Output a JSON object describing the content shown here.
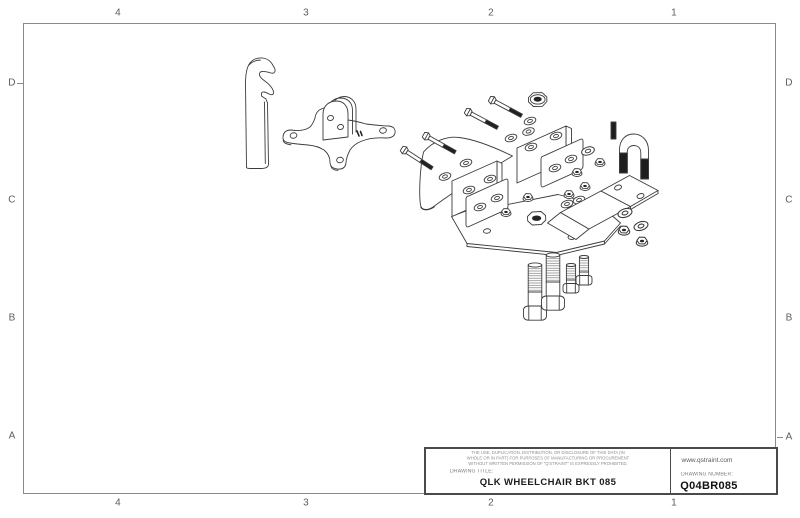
{
  "sheet": {
    "background": "#ffffff",
    "border_color": "#8a8a8a",
    "line_color": "#3c3c3c"
  },
  "zones": {
    "top": [
      "4",
      "3",
      "2",
      "1"
    ],
    "bottom": [
      "4",
      "3",
      "2",
      "1"
    ],
    "left": [
      "D",
      "C",
      "B",
      "A"
    ],
    "right": [
      "D",
      "C",
      "B",
      "A"
    ]
  },
  "title_block": {
    "disclaimer_line1": "THE USE, DUPLICATION, DISTRIBUTION, OR DISCLOSURE OF THIS DATA (IN",
    "disclaimer_line2": "WHOLE OR IN PART) FOR PURPOSES OF MANUFACTURING OR PROCUREMENT",
    "disclaimer_line3": "WITHOUT WRITTEN PERMISSION OF \"Q'STRAINT\" IS EXPRESSLY PROHIBITED.",
    "drawing_title_label": "DRAWING TITLE:",
    "drawing_title": "QLK WHEELCHAIR BKT 085",
    "website": "www.qstraint.com",
    "drawing_number_label": "DRAWING NUMBER:",
    "drawing_number": "Q04BR085"
  },
  "drawing": {
    "view": "exploded-isometric-assembly",
    "parts": [
      "hook-bracket-strip",
      "cross-base-plate-with-clevis",
      "angled-hex-bolts-x4",
      "flat-washers",
      "large-hex-nut",
      "main-bracket-weldment",
      "clamp-plates-x2",
      "flange-nuts",
      "threaded-stud",
      "u-bolt",
      "offset-z-bracket",
      "washer-and-nut-stacks",
      "vertical-hex-bolts-x4"
    ]
  }
}
